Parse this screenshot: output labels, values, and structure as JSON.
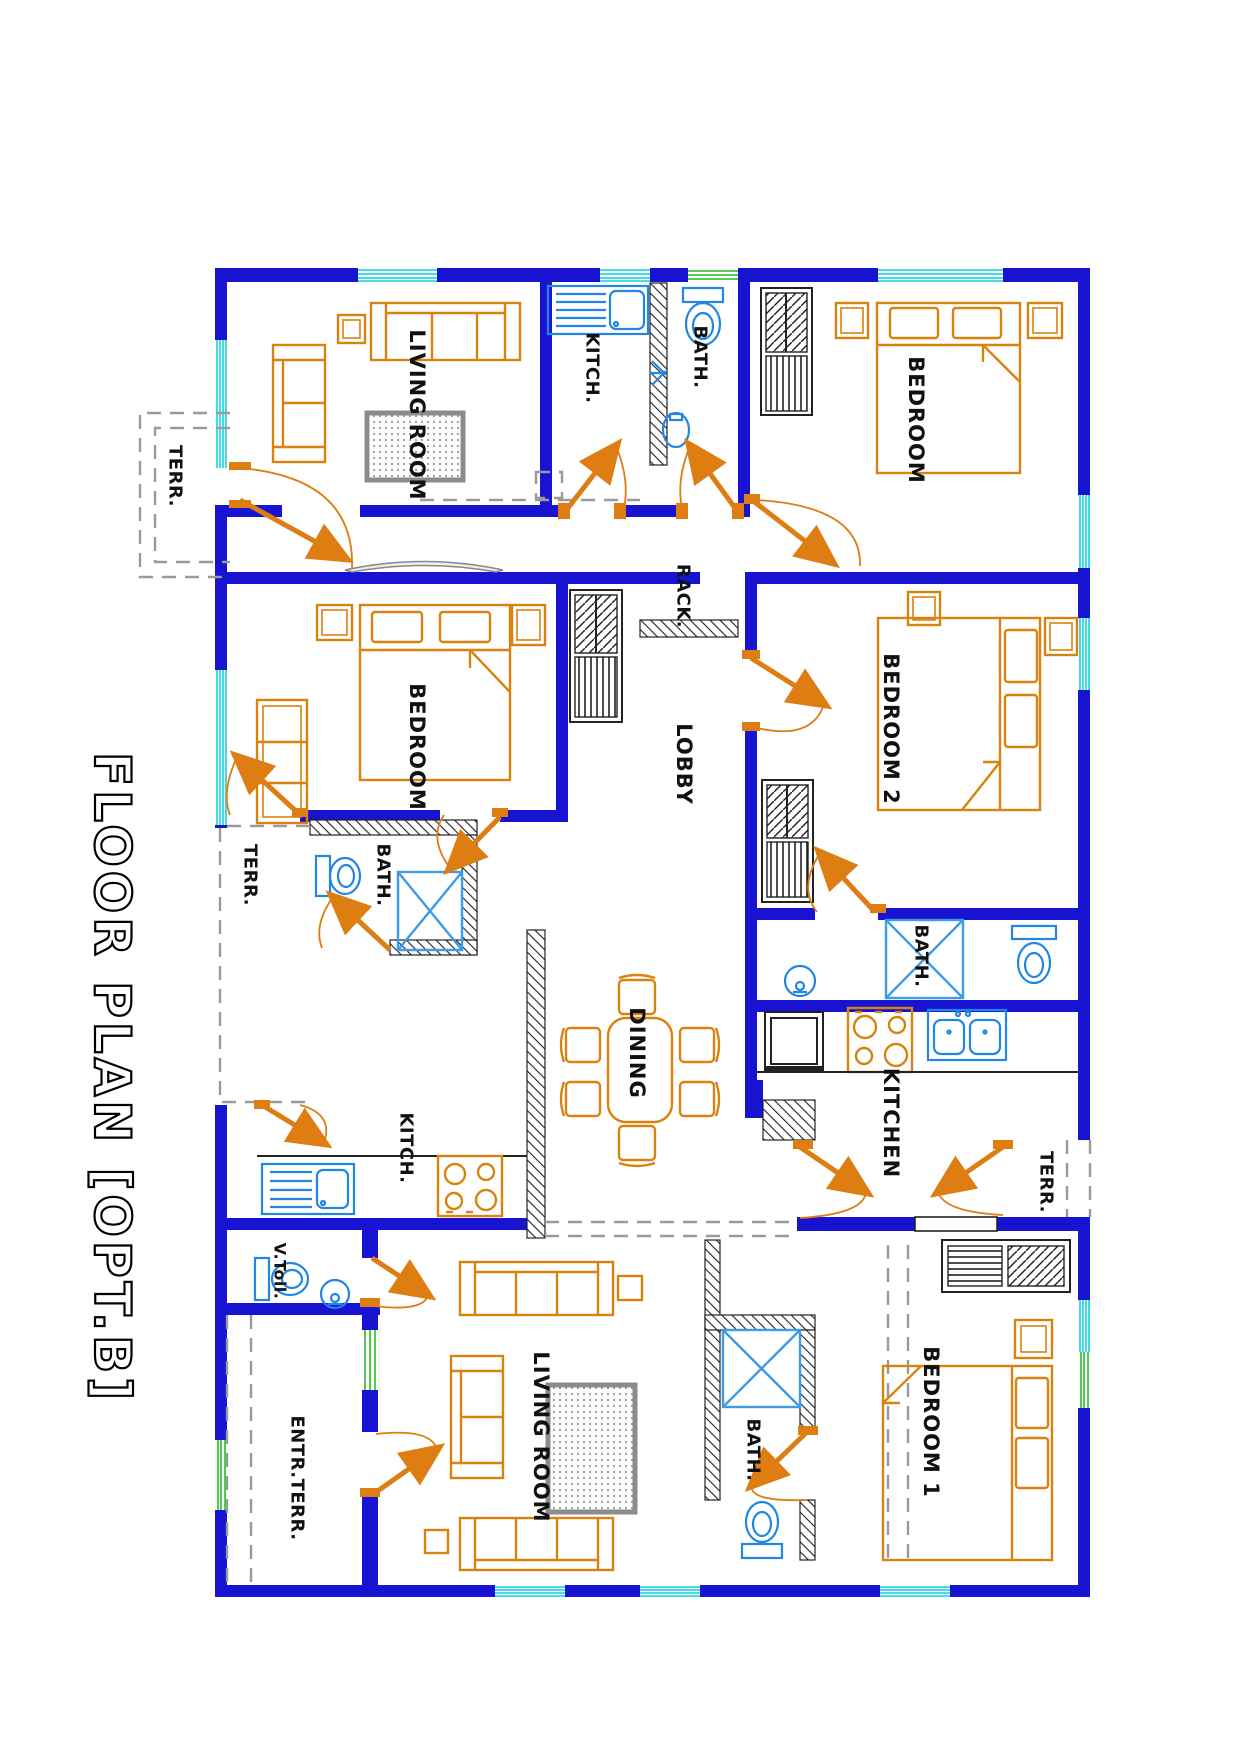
{
  "title": {
    "text": "FLOOR PLAN [OPT.B]"
  },
  "plan": {
    "rooms": [
      {
        "id": "living-top",
        "label": "LIVING ROOM"
      },
      {
        "id": "kitch-top",
        "label": "KITCH."
      },
      {
        "id": "bath-top",
        "label": "BATH."
      },
      {
        "id": "bedroom-top",
        "label": "BEDROOM"
      },
      {
        "id": "terr-top",
        "label": "TERR."
      },
      {
        "id": "rack",
        "label": "RACK."
      },
      {
        "id": "bedroom-mid",
        "label": "BEDROOM"
      },
      {
        "id": "lobby",
        "label": "LOBBY"
      },
      {
        "id": "bedroom-2",
        "label": "BEDROOM 2"
      },
      {
        "id": "terr-left",
        "label": "TERR."
      },
      {
        "id": "bath-left",
        "label": "BATH."
      },
      {
        "id": "bath-right",
        "label": "BATH."
      },
      {
        "id": "dining",
        "label": "DINING"
      },
      {
        "id": "kitchen",
        "label": "KITCHEN"
      },
      {
        "id": "kitch-left",
        "label": "KITCH."
      },
      {
        "id": "terr-right",
        "label": "TERR."
      },
      {
        "id": "v-toil",
        "label": "V.Toil."
      },
      {
        "id": "living-bottom",
        "label": "LIVING ROOM"
      },
      {
        "id": "entr-terr",
        "label": "ENTR.TERR."
      },
      {
        "id": "bath-bottom",
        "label": "BATH."
      },
      {
        "id": "bedroom-1",
        "label": "BEDROOM 1"
      }
    ],
    "colors": {
      "wall": "#1713d0",
      "window": "#2bd8e2",
      "vent_window": "#3ec43e",
      "furniture": "#d9820f",
      "fixture": "#2287e2",
      "door": "#dd7d12",
      "label": "#111111",
      "terrace_dash": "#9a9a9a",
      "rug": "#8c8c8c"
    }
  }
}
